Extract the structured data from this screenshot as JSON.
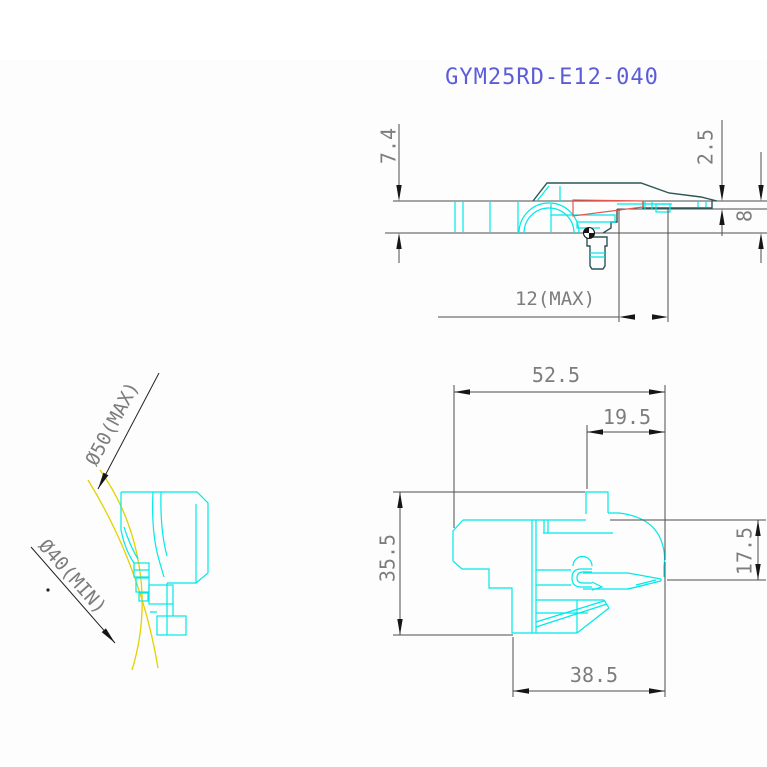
{
  "title": "GYM25RD-E12-040",
  "colors": {
    "title_blue": "#5c5cda",
    "drawing_cyan": "#00e9e9",
    "outline_teal": "#2c5656",
    "cantilever_red": "#e4574f",
    "record_arc_yellow": "#e3d200",
    "dimension_gray": "#7d7d7d",
    "line_gray": "#4d4d4d"
  },
  "views": {
    "side_view": {
      "name": "side elevation view",
      "dimensions": {
        "overall_height": "7.4",
        "top_thickness": "2.5",
        "mount_height": "8",
        "overhang": "12(MAX)"
      }
    },
    "front_view": {
      "name": "front view",
      "dimensions": {
        "overall_width": "52.5",
        "right_offset": "19.5",
        "overall_height": "35.5",
        "body_height": "17.5",
        "body_width": "38.5"
      }
    },
    "left_view": {
      "name": "left side view",
      "labels": {
        "max_diameter": "Ø50(MAX)",
        "min_diameter": "Ø40(MIN)"
      }
    }
  }
}
